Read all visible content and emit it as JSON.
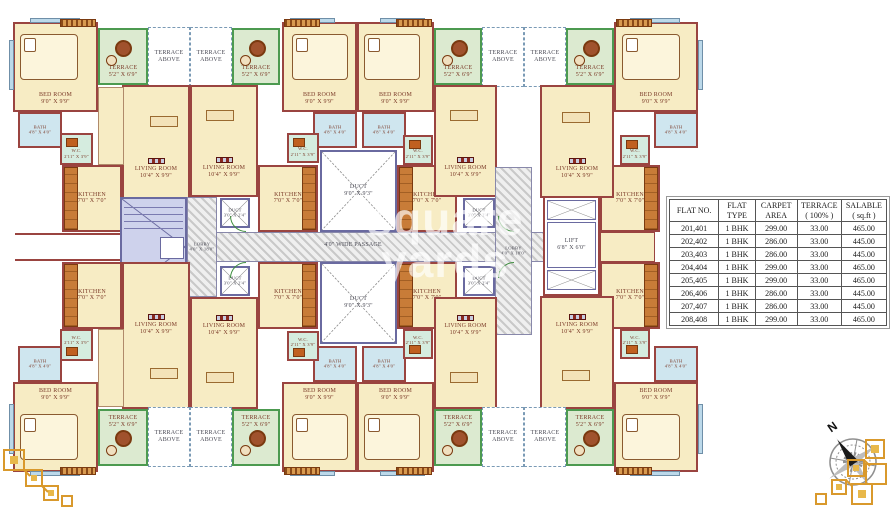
{
  "plan": {
    "labels": {
      "bedroom": "BED ROOM\n9'0\" X 9'9\"",
      "bath": "BATH\n4'8\" X 4'0\"",
      "wc": "W.C.\n2'11\" X 3'9\"",
      "kitchen": "KITCHEN\n7'0\" X 7'0\"",
      "living": "LIVING ROOM\n10'4\" X 9'9\"",
      "terrace": "TERRACE\n5'2\" X 6'9\"",
      "terrace_above": "TERRACE\nABOVE"
    },
    "core": {
      "passage": "4'0\" WIDE PASSAGE",
      "lobby": "LOBBY\n4'0\" X 18'0\"",
      "lift": "LIFT\n6'8\" X 6'0\"",
      "duct_large": "DUCT\n9'0\" X 9'3\"",
      "duct_small": "DUCT\n3'0\" X 2'4\""
    },
    "compass_label": "N"
  },
  "watermark": {
    "line1": "square",
    "line2": "yards"
  },
  "table": {
    "headers": [
      "FLAT NO.",
      "FLAT\nTYPE",
      "CARPET\nAREA",
      "TERRACE\n( 100% )",
      "SALABLE\n( sq.ft )"
    ],
    "rows": [
      [
        "201,401",
        "1 BHK",
        "299.00",
        "33.00",
        "465.00"
      ],
      [
        "202,402",
        "1 BHK",
        "286.00",
        "33.00",
        "445.00"
      ],
      [
        "203,403",
        "1 BHK",
        "286.00",
        "33.00",
        "445.00"
      ],
      [
        "204,404",
        "1 BHK",
        "299.00",
        "33.00",
        "465.00"
      ],
      [
        "205,405",
        "1 BHK",
        "299.00",
        "33.00",
        "465.00"
      ],
      [
        "206,406",
        "1 BHK",
        "286.00",
        "33.00",
        "445.00"
      ],
      [
        "207,407",
        "1 BHK",
        "286.00",
        "33.00",
        "445.00"
      ],
      [
        "208,408",
        "1 BHK",
        "299.00",
        "33.00",
        "465.00"
      ]
    ]
  },
  "colors": {
    "wall": "#9a4440",
    "room_fill": "#f7ecc4",
    "terrace_fill": "#dcead0",
    "bath_fill": "#cfe6ef",
    "wood_accent": "#c87c38",
    "stair_fill": "#ced2ec",
    "ornament_gold": "#d9992c"
  }
}
